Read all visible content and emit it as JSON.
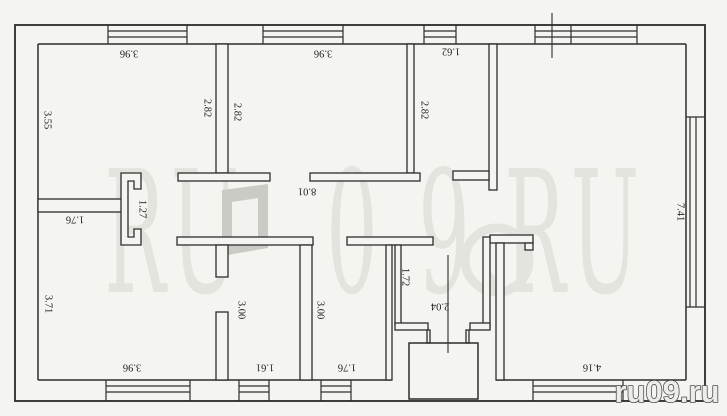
{
  "page": {
    "background": "#f4f4f1",
    "line_color": "#2d2d2d",
    "label_color": "#1e1e1e"
  },
  "floor_plan": {
    "units_note": "",
    "dimension_labels": [
      {
        "id": "room1-width-top",
        "value": "3.96",
        "x": 129,
        "y": 53,
        "rot": 180
      },
      {
        "id": "room1-height-left",
        "value": "3.55",
        "x": 47,
        "y": 120,
        "rot": 90
      },
      {
        "id": "room1-height-right",
        "value": "2.82",
        "x": 207,
        "y": 108,
        "rot": 90
      },
      {
        "id": "room2-width-top",
        "value": "3.96",
        "x": 323,
        "y": 53,
        "rot": 180
      },
      {
        "id": "room2-height-left",
        "value": "2.82",
        "x": 237,
        "y": 112,
        "rot": 90
      },
      {
        "id": "room3-width-top",
        "value": "1.62",
        "x": 451,
        "y": 51,
        "rot": 180
      },
      {
        "id": "room3-height-left",
        "value": "2.82",
        "x": 424,
        "y": 110,
        "rot": 90
      },
      {
        "id": "hall-length",
        "value": "8.01",
        "x": 307,
        "y": 191,
        "rot": 180
      },
      {
        "id": "hall-doorway-width",
        "value": "1.27",
        "x": 142,
        "y": 209,
        "rot": 90
      },
      {
        "id": "room4-width-top",
        "value": "1.76",
        "x": 75,
        "y": 219,
        "rot": 180
      },
      {
        "id": "room4-height-left",
        "value": "3.71",
        "x": 48,
        "y": 304,
        "rot": 90
      },
      {
        "id": "room4-width-bottom",
        "value": "3.96",
        "x": 132,
        "y": 367,
        "rot": 180
      },
      {
        "id": "room5-height",
        "value": "3.00",
        "x": 241,
        "y": 310,
        "rot": 90
      },
      {
        "id": "room5-width-bottom",
        "value": "1.61",
        "x": 265,
        "y": 367,
        "rot": 180
      },
      {
        "id": "room6-height",
        "value": "3.00",
        "x": 320,
        "y": 310,
        "rot": 90
      },
      {
        "id": "room6-width-bottom",
        "value": "1.76",
        "x": 347,
        "y": 367,
        "rot": 180
      },
      {
        "id": "vestibule-height",
        "value": "1.72",
        "x": 405,
        "y": 277,
        "rot": 90
      },
      {
        "id": "vestibule-width",
        "value": "2.04",
        "x": 440,
        "y": 306,
        "rot": 180
      },
      {
        "id": "room7-height-right",
        "value": "7.41",
        "x": 680,
        "y": 212,
        "rot": 90
      },
      {
        "id": "room7-width-bottom",
        "value": "4.16",
        "x": 592,
        "y": 367,
        "rot": 180
      }
    ]
  },
  "watermarks": {
    "large_text": "RU09.RU",
    "large_color": "#e2e2dd",
    "large_letter_x": [
      135,
      205,
      352,
      444,
      490,
      535,
      605
    ],
    "large_baseline_y": 292,
    "small_text": "ru09.ru",
    "small_fill": "#ececea",
    "small_outline": "#4f4f4f",
    "small_x": 667,
    "small_y": 402
  }
}
